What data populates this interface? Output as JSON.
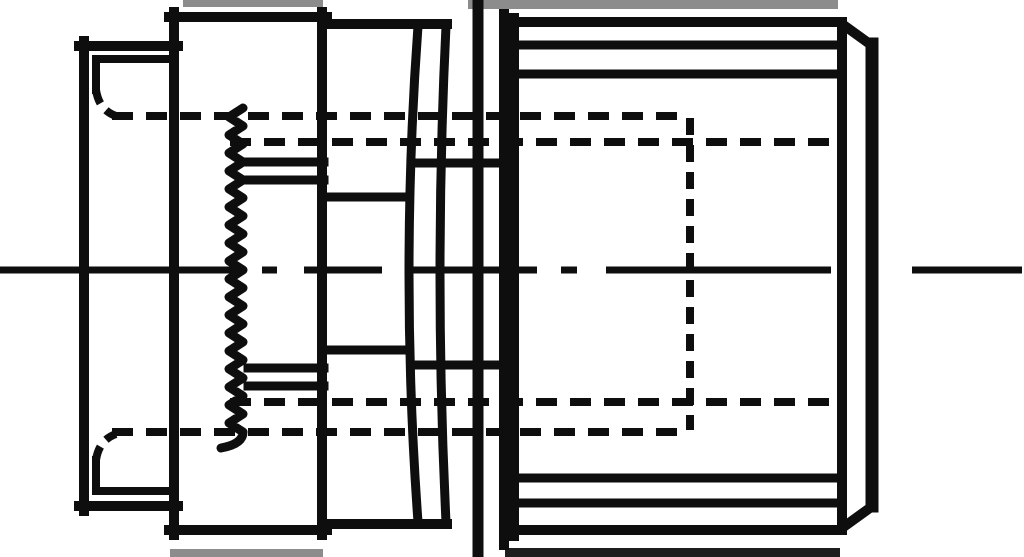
{
  "meta": {
    "description": "Black-and-white technical line drawing of a threaded hydraulic fitting adapter, side elevation, with hidden (dashed) thread and bore lines, serrated thread-engagement boundary, chamfered hex body on the right, and a horizontal dash-dot center line",
    "background": "#ffffff",
    "ink": "#0e0e0e",
    "grey_band": "#8c8c8c",
    "dark_band": "#1e1e1e"
  },
  "canvas": {
    "width": 1024,
    "height": 557
  },
  "drawing": {
    "bands": [
      {
        "name": "top-cut-band-left",
        "x": 183,
        "y": 0,
        "w": 140,
        "h": 7,
        "color": "grey"
      },
      {
        "name": "top-cut-band-right",
        "x": 468,
        "y": 0,
        "w": 370,
        "h": 9,
        "color": "grey"
      },
      {
        "name": "bottom-cut-band-left",
        "x": 170,
        "y": 549,
        "w": 153,
        "h": 8,
        "color": "grey"
      },
      {
        "name": "bottom-cut-band-right",
        "x": 505,
        "y": 548,
        "w": 335,
        "h": 9,
        "color": "dark"
      }
    ],
    "solid_lines": [
      {
        "name": "cap-left-edge",
        "x1": 84,
        "y1": 41,
        "x2": 84,
        "y2": 511,
        "w": 10
      },
      {
        "name": "cap-top-edge",
        "x1": 79,
        "y1": 46,
        "x2": 178,
        "y2": 46,
        "w": 10
      },
      {
        "name": "cap-bottom-edge",
        "x1": 79,
        "y1": 506,
        "x2": 178,
        "y2": 506,
        "w": 10
      },
      {
        "name": "cap-inner-top-line",
        "x1": 96,
        "y1": 59,
        "x2": 174,
        "y2": 59,
        "w": 8
      },
      {
        "name": "cap-inner-top-vertical",
        "x1": 96,
        "y1": 59,
        "x2": 96,
        "y2": 90,
        "w": 8
      },
      {
        "name": "cap-inner-bottom-line",
        "x1": 96,
        "y1": 491,
        "x2": 174,
        "y2": 491,
        "w": 8
      },
      {
        "name": "cap-inner-bottom-vertical",
        "x1": 96,
        "y1": 460,
        "x2": 96,
        "y2": 491,
        "w": 8
      },
      {
        "name": "sleeve-left-edge",
        "x1": 174,
        "y1": 12,
        "x2": 174,
        "y2": 535,
        "w": 10
      },
      {
        "name": "sleeve-top-edge",
        "x1": 169,
        "y1": 17,
        "x2": 327,
        "y2": 17,
        "w": 10
      },
      {
        "name": "sleeve-bottom-edge",
        "x1": 169,
        "y1": 530,
        "x2": 327,
        "y2": 530,
        "w": 10
      },
      {
        "name": "sleeve-right-edge",
        "x1": 322,
        "y1": 12,
        "x2": 322,
        "y2": 535,
        "w": 10
      },
      {
        "name": "collar-top-edge",
        "x1": 322,
        "y1": 24,
        "x2": 447,
        "y2": 24,
        "w": 10
      },
      {
        "name": "collar-bottom-edge",
        "x1": 322,
        "y1": 524,
        "x2": 447,
        "y2": 524,
        "w": 10
      },
      {
        "name": "flange-outer-edge",
        "x1": 478,
        "y1": 0,
        "x2": 478,
        "y2": 557,
        "w": 11
      },
      {
        "name": "flange-inner-edge",
        "x1": 504,
        "y1": 14,
        "x2": 504,
        "y2": 545,
        "w": 10
      },
      {
        "name": "body-left-edge",
        "x1": 514,
        "y1": 18,
        "x2": 514,
        "y2": 536,
        "w": 10
      },
      {
        "name": "body-top-edge",
        "x1": 509,
        "y1": 22,
        "x2": 842,
        "y2": 22,
        "w": 10
      },
      {
        "name": "body-bottom-edge",
        "x1": 509,
        "y1": 530,
        "x2": 842,
        "y2": 530,
        "w": 10
      },
      {
        "name": "body-thread-line-top",
        "x1": 520,
        "y1": 45,
        "x2": 838,
        "y2": 45,
        "w": 9
      },
      {
        "name": "body-chamfer-line-top",
        "x1": 520,
        "y1": 74,
        "x2": 838,
        "y2": 74,
        "w": 9
      },
      {
        "name": "body-thread-line-bottom",
        "x1": 520,
        "y1": 503,
        "x2": 838,
        "y2": 503,
        "w": 9
      },
      {
        "name": "body-chamfer-line-bottom",
        "x1": 520,
        "y1": 478,
        "x2": 838,
        "y2": 478,
        "w": 9
      },
      {
        "name": "body-face-edge",
        "x1": 842,
        "y1": 26,
        "x2": 842,
        "y2": 526,
        "w": 10
      },
      {
        "name": "body-right-edge",
        "x1": 872,
        "y1": 44,
        "x2": 872,
        "y2": 506,
        "w": 13
      },
      {
        "name": "bore-step-top-a",
        "x1": 248,
        "y1": 162,
        "x2": 324,
        "y2": 162,
        "w": 9
      },
      {
        "name": "bore-step-top-b",
        "x1": 248,
        "y1": 180,
        "x2": 324,
        "y2": 180,
        "w": 9
      },
      {
        "name": "bore-step-top-c",
        "x1": 322,
        "y1": 197,
        "x2": 406,
        "y2": 197,
        "w": 9
      },
      {
        "name": "bore-step-top-d",
        "x1": 413,
        "y1": 163,
        "x2": 502,
        "y2": 163,
        "w": 9
      },
      {
        "name": "bore-step-bottom-a",
        "x1": 248,
        "y1": 386,
        "x2": 324,
        "y2": 386,
        "w": 9
      },
      {
        "name": "bore-step-bottom-b",
        "x1": 248,
        "y1": 368,
        "x2": 324,
        "y2": 368,
        "w": 9
      },
      {
        "name": "bore-step-bottom-c",
        "x1": 322,
        "y1": 350,
        "x2": 406,
        "y2": 350,
        "w": 9
      },
      {
        "name": "bore-step-bottom-d",
        "x1": 413,
        "y1": 365,
        "x2": 502,
        "y2": 365,
        "w": 9
      }
    ],
    "paths": [
      {
        "name": "body-corner-chamfer-top",
        "d": "M838,21 L874,47",
        "w": 10
      },
      {
        "name": "body-corner-chamfer-bottom",
        "d": "M838,531 L874,505",
        "w": 10
      },
      {
        "name": "collar-silhouette-inner",
        "d": "M418,26 Q400,274 418,522",
        "w": 9
      },
      {
        "name": "collar-silhouette-outer",
        "d": "M446,26 Q434,274 446,522",
        "w": 9
      },
      {
        "name": "thread-relief-arc-top",
        "d": "M96,90 Q99,110 116,116",
        "w": 8,
        "dash": [
          14,
          9
        ]
      },
      {
        "name": "thread-relief-arc-bottom",
        "d": "M96,460 Q99,440 116,434",
        "w": 8,
        "dash": [
          14,
          9
        ]
      }
    ],
    "dashed_lines": [
      {
        "name": "hidden-thread-top-outer",
        "x1": 112,
        "y1": 116,
        "x2": 688,
        "y2": 116,
        "w": 8,
        "dash": [
          21,
          13
        ]
      },
      {
        "name": "hidden-thread-top-inner",
        "x1": 230,
        "y1": 142,
        "x2": 834,
        "y2": 142,
        "w": 8,
        "dash": [
          21,
          13
        ]
      },
      {
        "name": "hidden-thread-bottom-outer",
        "x1": 112,
        "y1": 432,
        "x2": 688,
        "y2": 432,
        "w": 8,
        "dash": [
          21,
          13
        ]
      },
      {
        "name": "hidden-thread-bottom-inner",
        "x1": 230,
        "y1": 402,
        "x2": 834,
        "y2": 402,
        "w": 8,
        "dash": [
          21,
          13
        ]
      },
      {
        "name": "hidden-bore-end-vertical",
        "x1": 690,
        "y1": 118,
        "x2": 690,
        "y2": 430,
        "w": 8,
        "dash": [
          17,
          10
        ]
      }
    ],
    "serration": {
      "name": "thread-engagement-serrated-line",
      "x_out": 243,
      "x_in": 229,
      "y_top": 108,
      "y_bottom": 432,
      "half_pitch": 9,
      "stroke": 9,
      "hook": [
        221,
        448
      ]
    },
    "centerline": {
      "name": "horizontal-centerline",
      "y": 270,
      "width": 7,
      "segments": [
        [
          0,
          237
        ],
        [
          262,
          277
        ],
        [
          304,
          382
        ],
        [
          408,
          537
        ],
        [
          561,
          577
        ],
        [
          606,
          831
        ],
        [
          912,
          1022
        ]
      ]
    }
  }
}
